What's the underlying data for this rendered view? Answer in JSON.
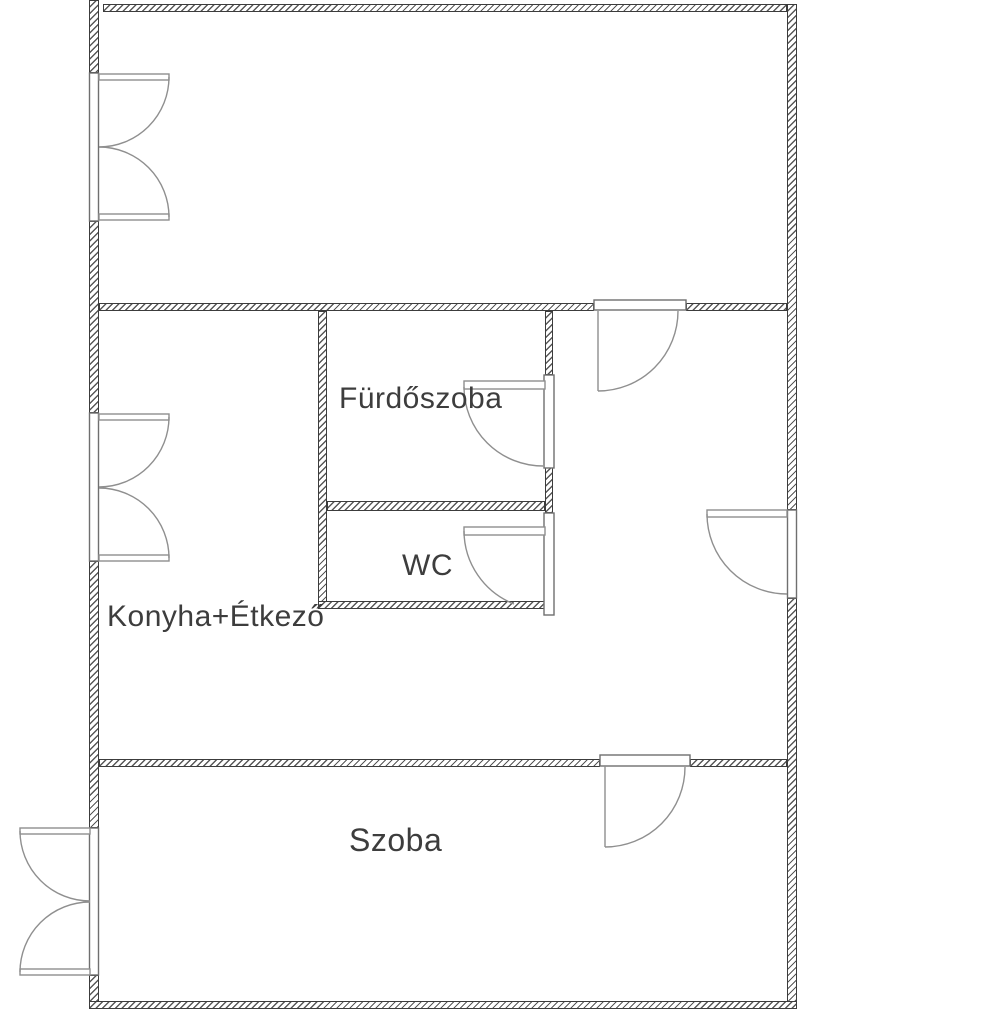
{
  "plan": {
    "kind": "apartment floor plan",
    "background": "#ffffff"
  },
  "colors": {
    "wall_outline": "#3c3c3c",
    "wall_hatch": "#585858",
    "door_swing_line": "#8f8f8f",
    "label_text": "#3d3d3d"
  },
  "rooms": [
    {
      "id": "furdoszoba",
      "label": "Fürdőszoba"
    },
    {
      "id": "wc",
      "label": "WC"
    },
    {
      "id": "konyha_etkezo",
      "label": "Konyha+Étkező"
    },
    {
      "id": "szoba",
      "label": "Szoba"
    }
  ],
  "features": {
    "doors": [
      "door-top-room-to-hall",
      "door-bathroom",
      "door-wc",
      "door-entrance-right-wall",
      "door-szoba"
    ],
    "windows": [
      "window-top-room-left",
      "window-kitchen-left",
      "french-window-szoba-left-opening-out"
    ]
  }
}
